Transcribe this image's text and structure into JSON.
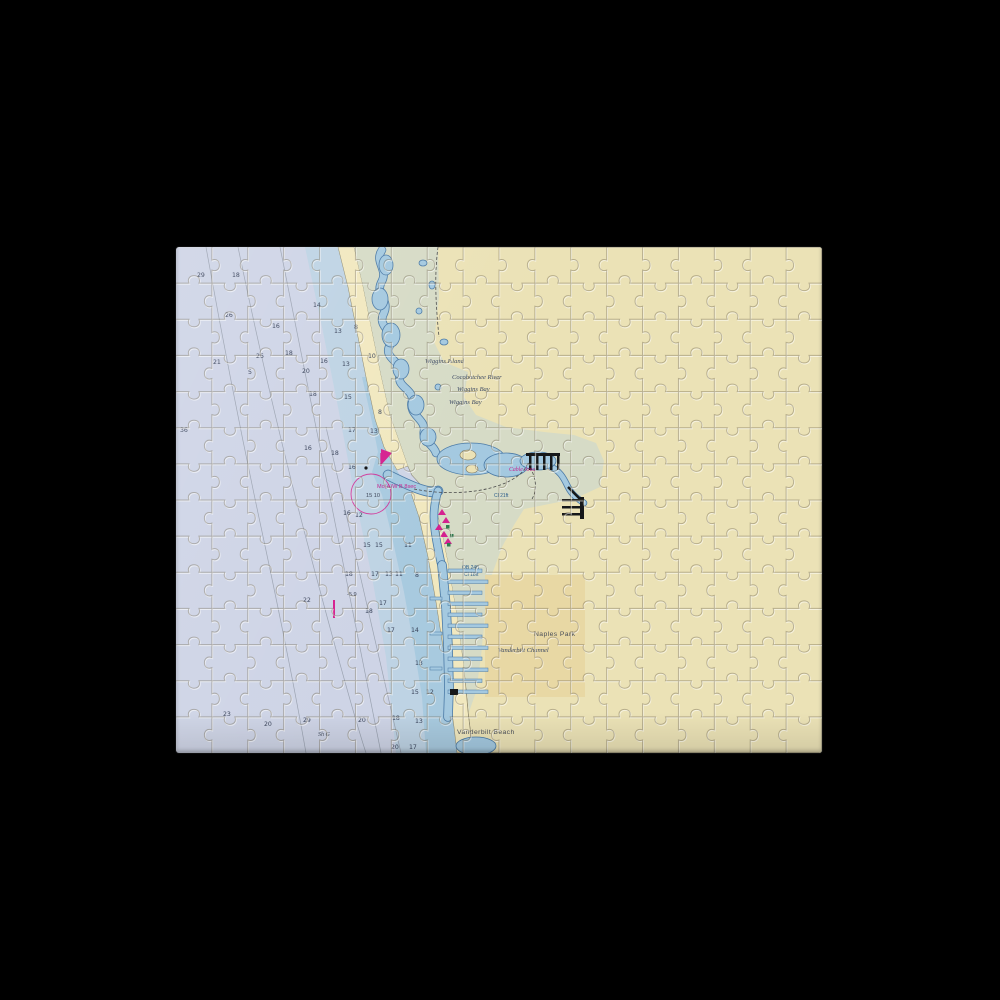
{
  "scene": {
    "background_color": "#000000"
  },
  "puzzle": {
    "left": 176,
    "top": 247,
    "width": 646,
    "height": 506,
    "cols": 18,
    "rows": 14
  },
  "palette": {
    "sea_deep": "#ced4e6",
    "sea_mid": "#bed3e4",
    "sea_near": "#a8cadf",
    "inland_water": "#a4c9e0",
    "water_outline": "#4b7aa6",
    "beach": "#f1e8bf",
    "land": "#ebe2b6",
    "urban": "#e8d7a3",
    "marsh": "#d6dbc6",
    "contour": "#9aa2b0",
    "magenta": "#d5218f",
    "green_marker": "#2e7d4f",
    "black_feature": "#16181a",
    "label_text": "#3d4a63",
    "sounding_text": "#39435a"
  },
  "map": {
    "labels": [
      {
        "text": "Wiggins Island",
        "x": 249,
        "y": 116,
        "cls": "lbl-place"
      },
      {
        "text": "Cocohatchee River",
        "x": 276,
        "y": 132,
        "cls": "lbl-place"
      },
      {
        "text": "Wiggins Bay",
        "x": 281,
        "y": 144,
        "cls": "lbl-place"
      },
      {
        "text": "Wiggins Bay",
        "x": 273,
        "y": 157,
        "cls": "lbl-place"
      },
      {
        "text": "Naples Park",
        "x": 358,
        "y": 389,
        "cls": "lbl-town"
      },
      {
        "text": "Vanderbilt Channel",
        "x": 322,
        "y": 405,
        "cls": "lbl-place"
      },
      {
        "text": "Vanderbilt Beach",
        "x": 281,
        "y": 487,
        "cls": "lbl-town"
      },
      {
        "text": "Mo(A)W B 8sec",
        "x": 201,
        "y": 241,
        "cls": "lbl-magenta"
      },
      {
        "text": "15  10",
        "x": 190,
        "y": 250,
        "cls": "lbl-note"
      },
      {
        "text": "Cable Area",
        "x": 333,
        "y": 224,
        "cls": "lbl-magenta-it"
      },
      {
        "text": "Cl 21ft",
        "x": 318,
        "y": 250,
        "cls": "lbl-clearance"
      },
      {
        "text": "OB 24ft",
        "x": 286,
        "y": 322,
        "cls": "lbl-clearance"
      },
      {
        "text": "Cl 18ft",
        "x": 288,
        "y": 329,
        "cls": "lbl-clearance"
      },
      {
        "text": "-5.9",
        "x": 171,
        "y": 349,
        "cls": "lbl-note"
      },
      {
        "text": "Sh G",
        "x": 142,
        "y": 489,
        "cls": "lbl-bottom"
      }
    ],
    "soundings": [
      {
        "v": "29",
        "x": 21,
        "y": 30
      },
      {
        "v": "18",
        "x": 56,
        "y": 30
      },
      {
        "v": "26",
        "x": 49,
        "y": 70
      },
      {
        "v": "16",
        "x": 96,
        "y": 81
      },
      {
        "v": "14",
        "x": 137,
        "y": 60
      },
      {
        "v": "13",
        "x": 158,
        "y": 86
      },
      {
        "v": "8",
        "x": 178,
        "y": 82
      },
      {
        "v": "21",
        "x": 37,
        "y": 117
      },
      {
        "v": "26",
        "x": 80,
        "y": 111
      },
      {
        "v": "18",
        "x": 109,
        "y": 108
      },
      {
        "v": "16",
        "x": 144,
        "y": 116
      },
      {
        "v": "13",
        "x": 166,
        "y": 119
      },
      {
        "v": "5",
        "x": 72,
        "y": 127
      },
      {
        "v": "20",
        "x": 126,
        "y": 126
      },
      {
        "v": "10",
        "x": 192,
        "y": 111
      },
      {
        "v": "18",
        "x": 133,
        "y": 149
      },
      {
        "v": "15",
        "x": 168,
        "y": 152
      },
      {
        "v": "8",
        "x": 202,
        "y": 167
      },
      {
        "v": "17",
        "x": 172,
        "y": 185
      },
      {
        "v": "13",
        "x": 194,
        "y": 186
      },
      {
        "v": "16",
        "x": 128,
        "y": 203
      },
      {
        "v": "18",
        "x": 155,
        "y": 208
      },
      {
        "v": "16",
        "x": 172,
        "y": 222
      },
      {
        "v": "36",
        "x": 4,
        "y": 185
      },
      {
        "v": "12",
        "x": 179,
        "y": 270
      },
      {
        "v": "16",
        "x": 167,
        "y": 268
      },
      {
        "v": "15",
        "x": 187,
        "y": 300
      },
      {
        "v": "15",
        "x": 199,
        "y": 300
      },
      {
        "v": "11",
        "x": 228,
        "y": 300
      },
      {
        "v": "18",
        "x": 169,
        "y": 329
      },
      {
        "v": "17",
        "x": 195,
        "y": 329
      },
      {
        "v": "13",
        "x": 209,
        "y": 329
      },
      {
        "v": "11",
        "x": 219,
        "y": 329
      },
      {
        "v": "8",
        "x": 239,
        "y": 330
      },
      {
        "v": "22",
        "x": 127,
        "y": 355
      },
      {
        "v": "17",
        "x": 203,
        "y": 358
      },
      {
        "v": "18",
        "x": 189,
        "y": 366
      },
      {
        "v": "17",
        "x": 211,
        "y": 385
      },
      {
        "v": "14",
        "x": 235,
        "y": 385
      },
      {
        "v": "13",
        "x": 239,
        "y": 418
      },
      {
        "v": "15",
        "x": 235,
        "y": 447
      },
      {
        "v": "12",
        "x": 250,
        "y": 447
      },
      {
        "v": "23",
        "x": 47,
        "y": 469
      },
      {
        "v": "20",
        "x": 88,
        "y": 479
      },
      {
        "v": "29",
        "x": 127,
        "y": 475
      },
      {
        "v": "20",
        "x": 182,
        "y": 475
      },
      {
        "v": "18",
        "x": 216,
        "y": 473
      },
      {
        "v": "13",
        "x": 239,
        "y": 476
      },
      {
        "v": "20",
        "x": 215,
        "y": 502
      },
      {
        "v": "17",
        "x": 233,
        "y": 502
      }
    ]
  }
}
